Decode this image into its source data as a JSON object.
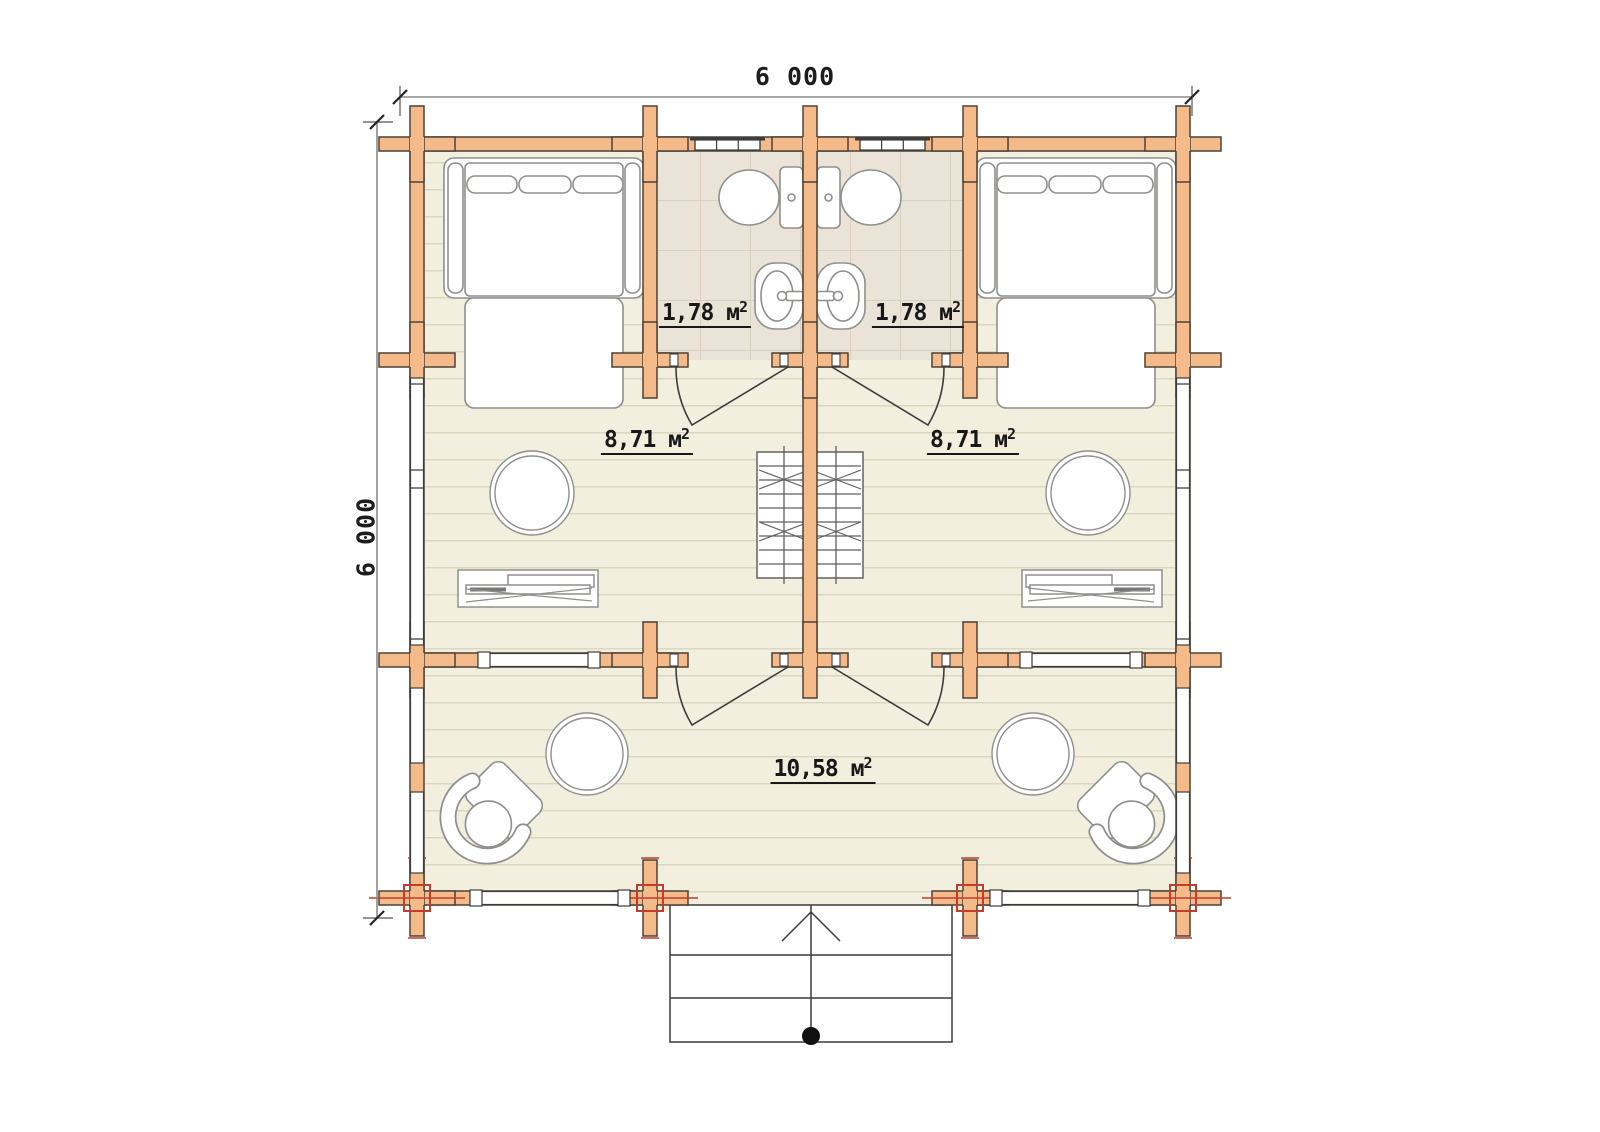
{
  "drawing_title": "log cabin floor plan 6x6 with two bedrooms, two bathrooms and living room",
  "dimension_labels": {
    "top": "6 000",
    "left": "6 000"
  },
  "room_labels": [
    {
      "room": "bathroom-left",
      "area": "1,78 м",
      "sup": "2"
    },
    {
      "room": "bathroom-right",
      "area": "1,78 м",
      "sup": "2"
    },
    {
      "room": "bedroom-left",
      "area": "8,71 м",
      "sup": "2"
    },
    {
      "room": "bedroom-right",
      "area": "8,71 м",
      "sup": "2"
    },
    {
      "room": "living-room",
      "area": "10,58 м",
      "sup": "2"
    }
  ],
  "symbols": [
    "double-bed",
    "toilet",
    "washbasin",
    "round-side-table",
    "desk",
    "loft-ladder",
    "coffee-table",
    "corner-armchair",
    "entrance-steps",
    "entry-direction-arrow",
    "door-swing",
    "window",
    "log-joint-cross"
  ],
  "colors": {
    "background": "#ffffff",
    "wall_fill": "#f4ba8a",
    "wall_outline": "#4c4237",
    "floor": "#f2efdf",
    "floor_plank_line": "#dcd7bf",
    "bathroom_floor": "#eae3d7",
    "bathroom_tile_line": "#d9d0c0",
    "furniture_outline": "#8f8f8d",
    "door_line": "#3c3c3c",
    "dimension_line": "#8a8a8a",
    "label_text": "#181818",
    "section_marker_red": "#c43c2c"
  }
}
